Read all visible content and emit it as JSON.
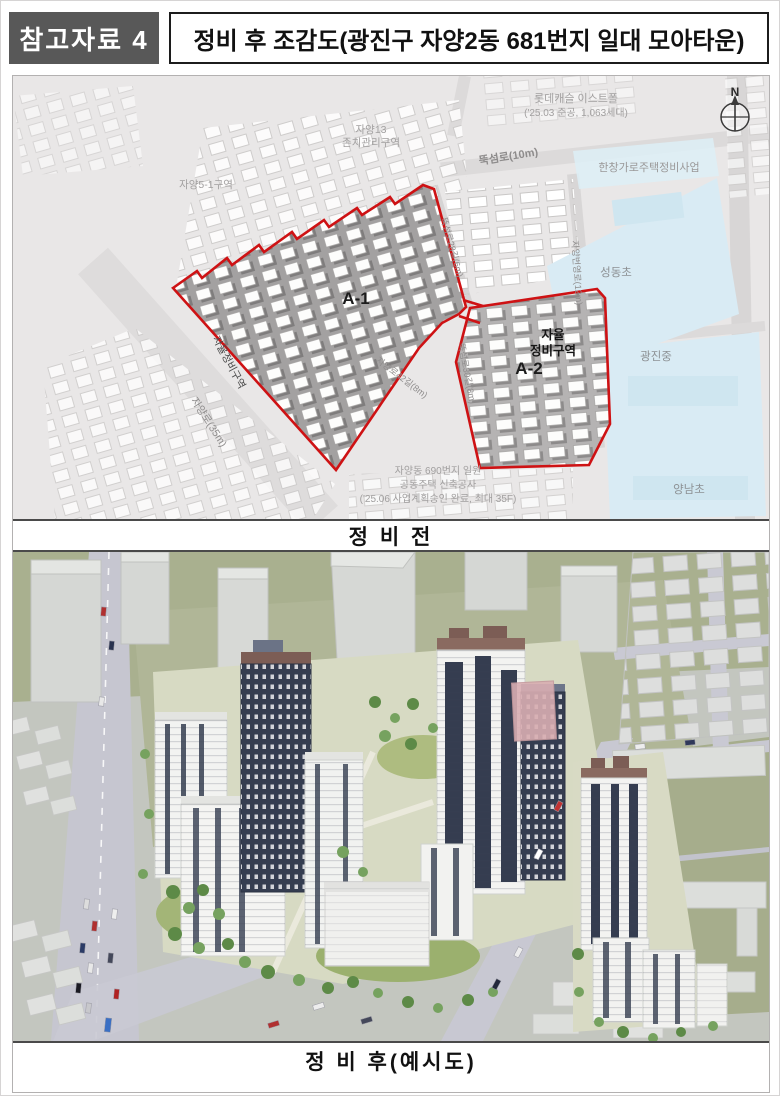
{
  "header": {
    "badge": "참고자료 4",
    "title": "정비 후 조감도(광진구 자양2동 681번지 일대 모아타운)"
  },
  "map": {
    "compass_n": "N",
    "lotte_line1": "롯데캐슬 이스트폴",
    "lotte_line2": "('25.03 준공, 1,063세대)",
    "jayang13_line1": "자양13",
    "jayang13_line2": "존치관리구역",
    "jayang5_1": "자양5-1구역",
    "road_ttukseomro": "뚝섬로(10m)",
    "hanchang": "한창가로주택정비사업",
    "school_seongdong": "성동초",
    "school_gwangjin": "광진중",
    "school_yangnam": "양남초",
    "zone_a1": "A-1",
    "zone_a2": "A-2",
    "jayul_line1": "자율",
    "jayul_line2": "정비구역",
    "jayul_left": "자율정비구역",
    "road_jayangro": "자양로(35m)",
    "road_divider": "뚝섬로28길(6m)",
    "road_beonyeong": "자양번영로(12m)",
    "road_a2west": "뚝섬로30길(8m)",
    "road_jayang42": "자양로42길(8m)",
    "note_line1": "자양동 690번지 일원",
    "note_line2": "공동주택 신축공사",
    "note_line3": "('25.06 사업계획승인 완료, 최대 35F)"
  },
  "captions": {
    "before": "정 비 전",
    "after": "정 비 후(예시도)"
  },
  "colors": {
    "boundary_red": "#ce1214",
    "school_blue": "#d9ebf4",
    "badge_bg": "#585858",
    "tower_navy": "#353d50",
    "field_olive": "#a9b08f"
  }
}
